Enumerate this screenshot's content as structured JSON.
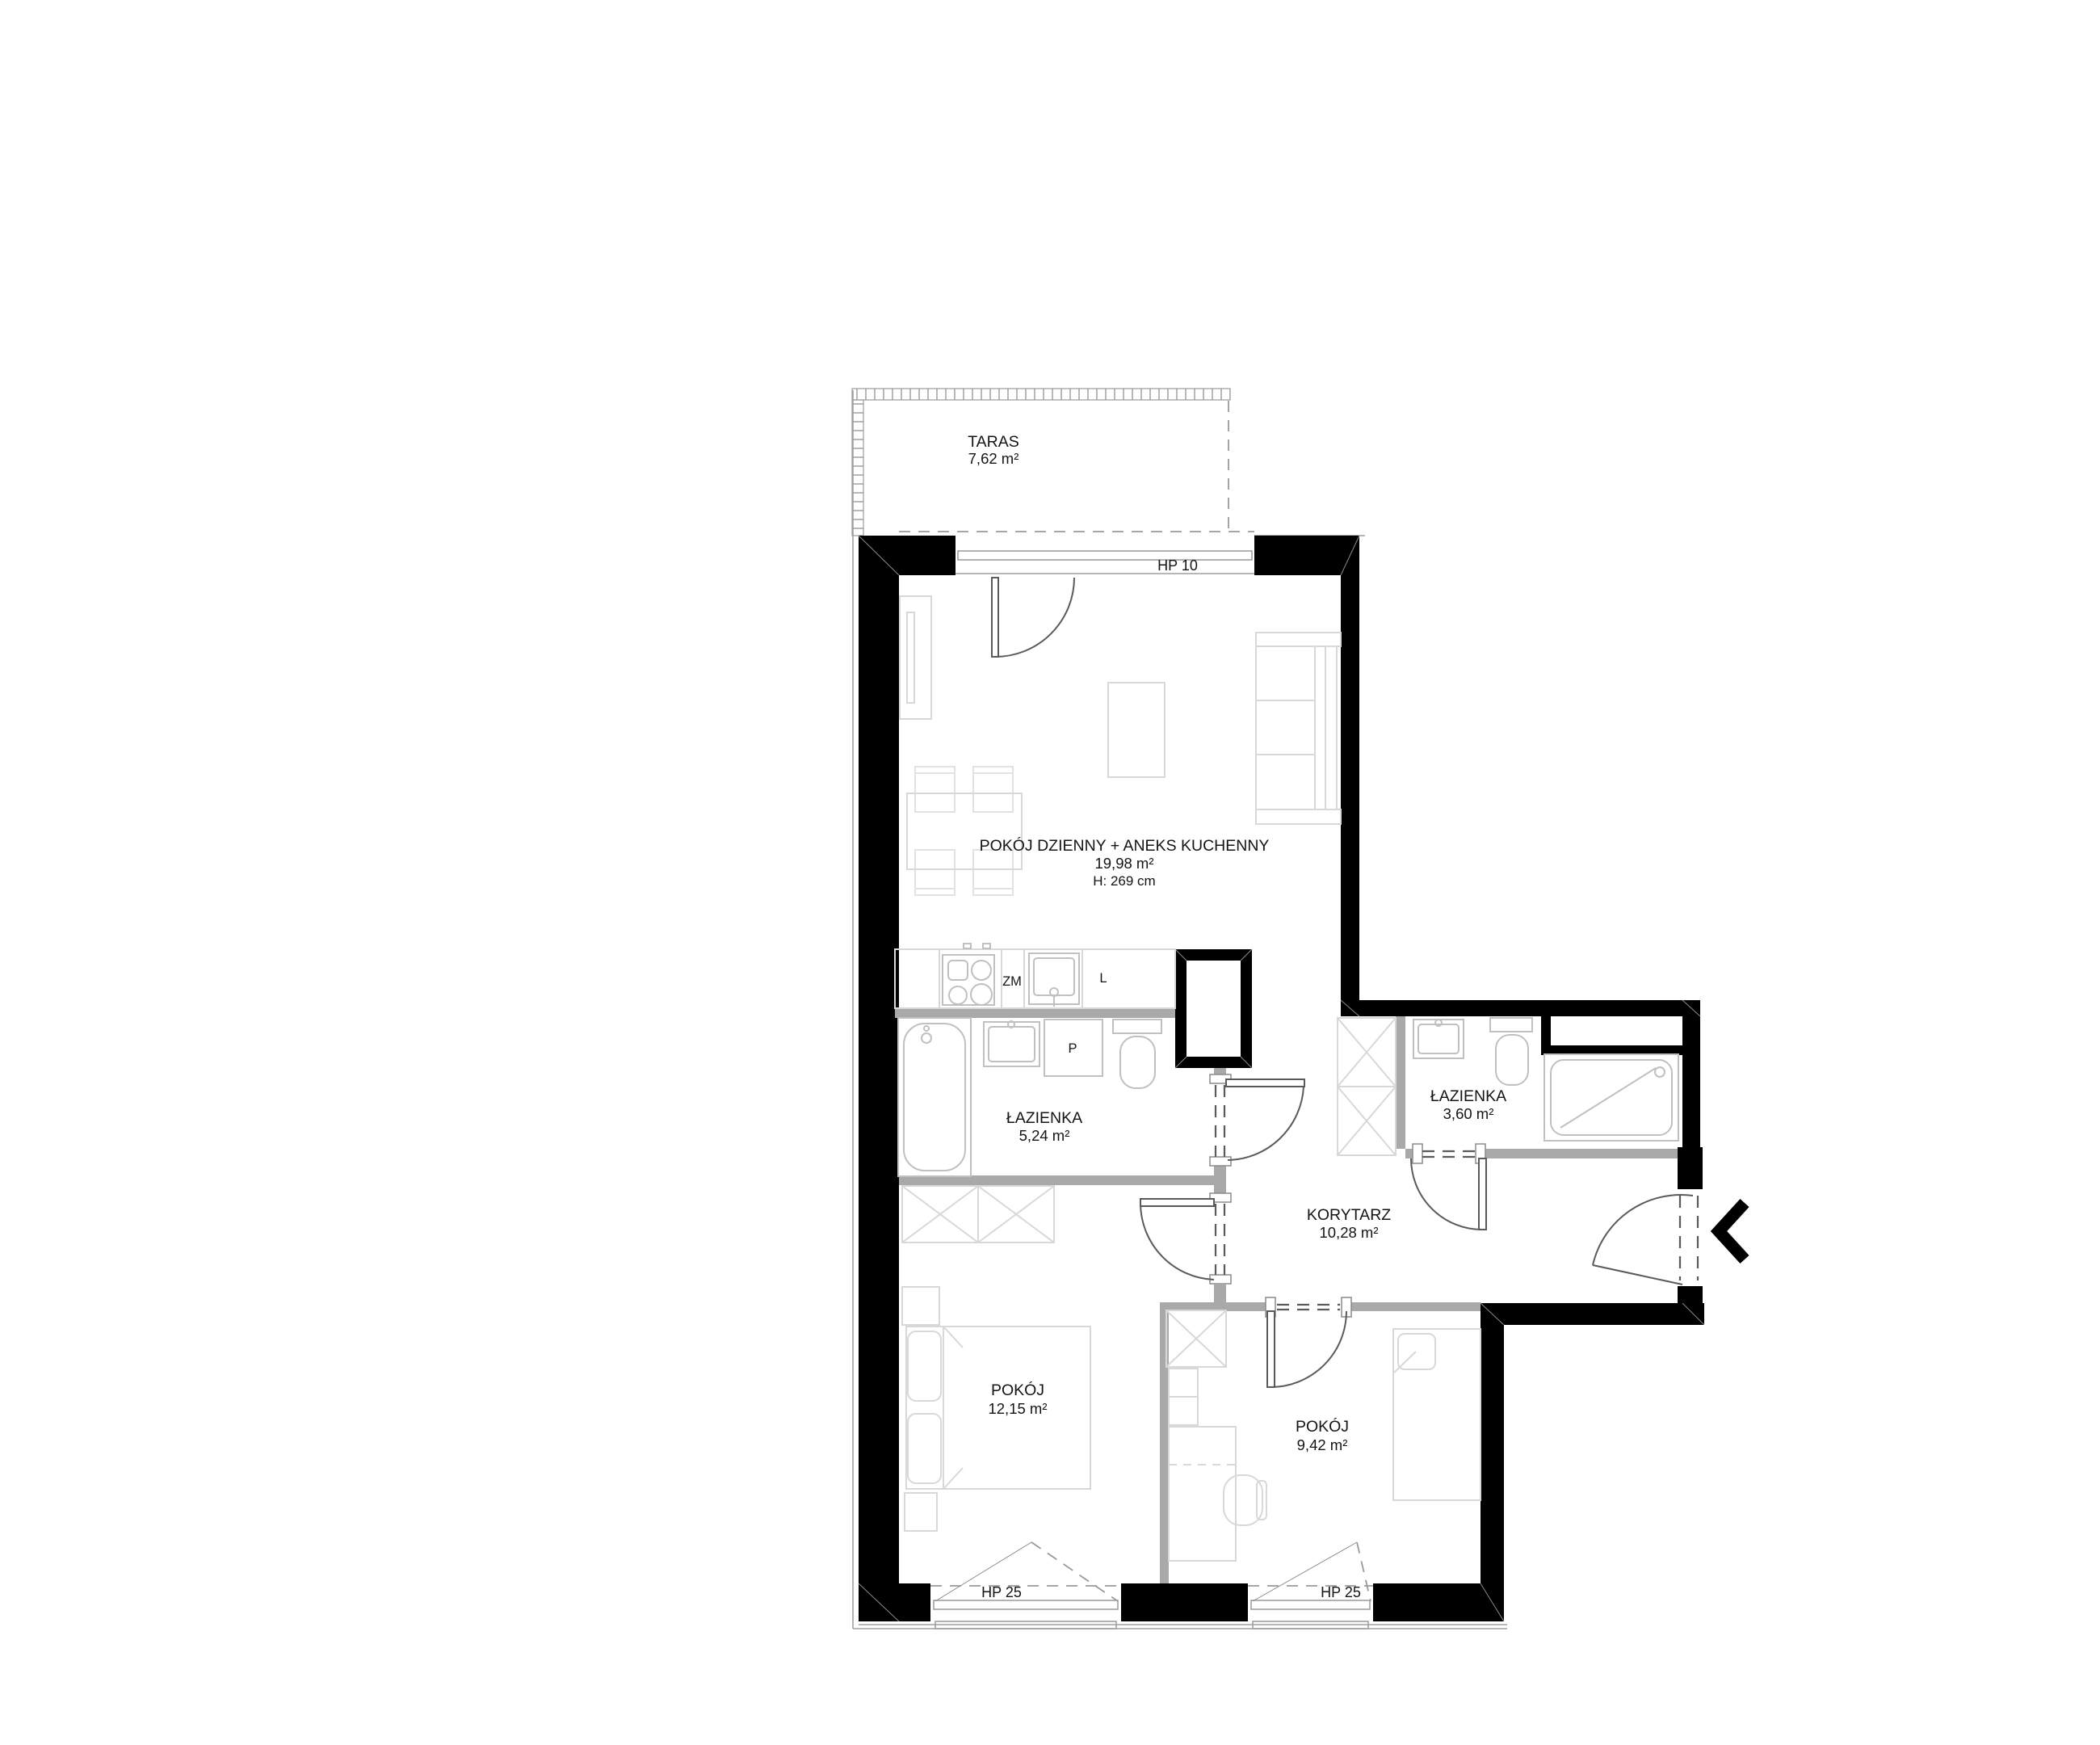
{
  "plan": {
    "terrace": {
      "name": "TARAS",
      "area": "7,62 m²"
    },
    "living": {
      "name": "POKÓJ DZIENNY + ANEKS KUCHENNY",
      "area": "19,98 m²",
      "height": "H: 269 cm"
    },
    "bath1": {
      "name": "ŁAZIENKA",
      "area": "5,24 m²",
      "washer_label": "P"
    },
    "bath2": {
      "name": "ŁAZIENKA",
      "area": "3,60 m²"
    },
    "corridor": {
      "name": "KORYTARZ",
      "area": "10,28 m²"
    },
    "room1": {
      "name": "POKÓJ",
      "area": "12,15 m²"
    },
    "room2": {
      "name": "POKÓJ",
      "area": "9,42 m²"
    },
    "windows": {
      "hp10": "HP 10",
      "hp25_left": "HP 25",
      "hp25_right": "HP 25"
    },
    "kitchen": {
      "dishwasher_label": "ZM",
      "fridge_label": "L"
    },
    "colors": {
      "wall": "#000000",
      "partition": "#a9a9a9",
      "furniture": "#d8d8d8",
      "background": "#ffffff"
    }
  }
}
